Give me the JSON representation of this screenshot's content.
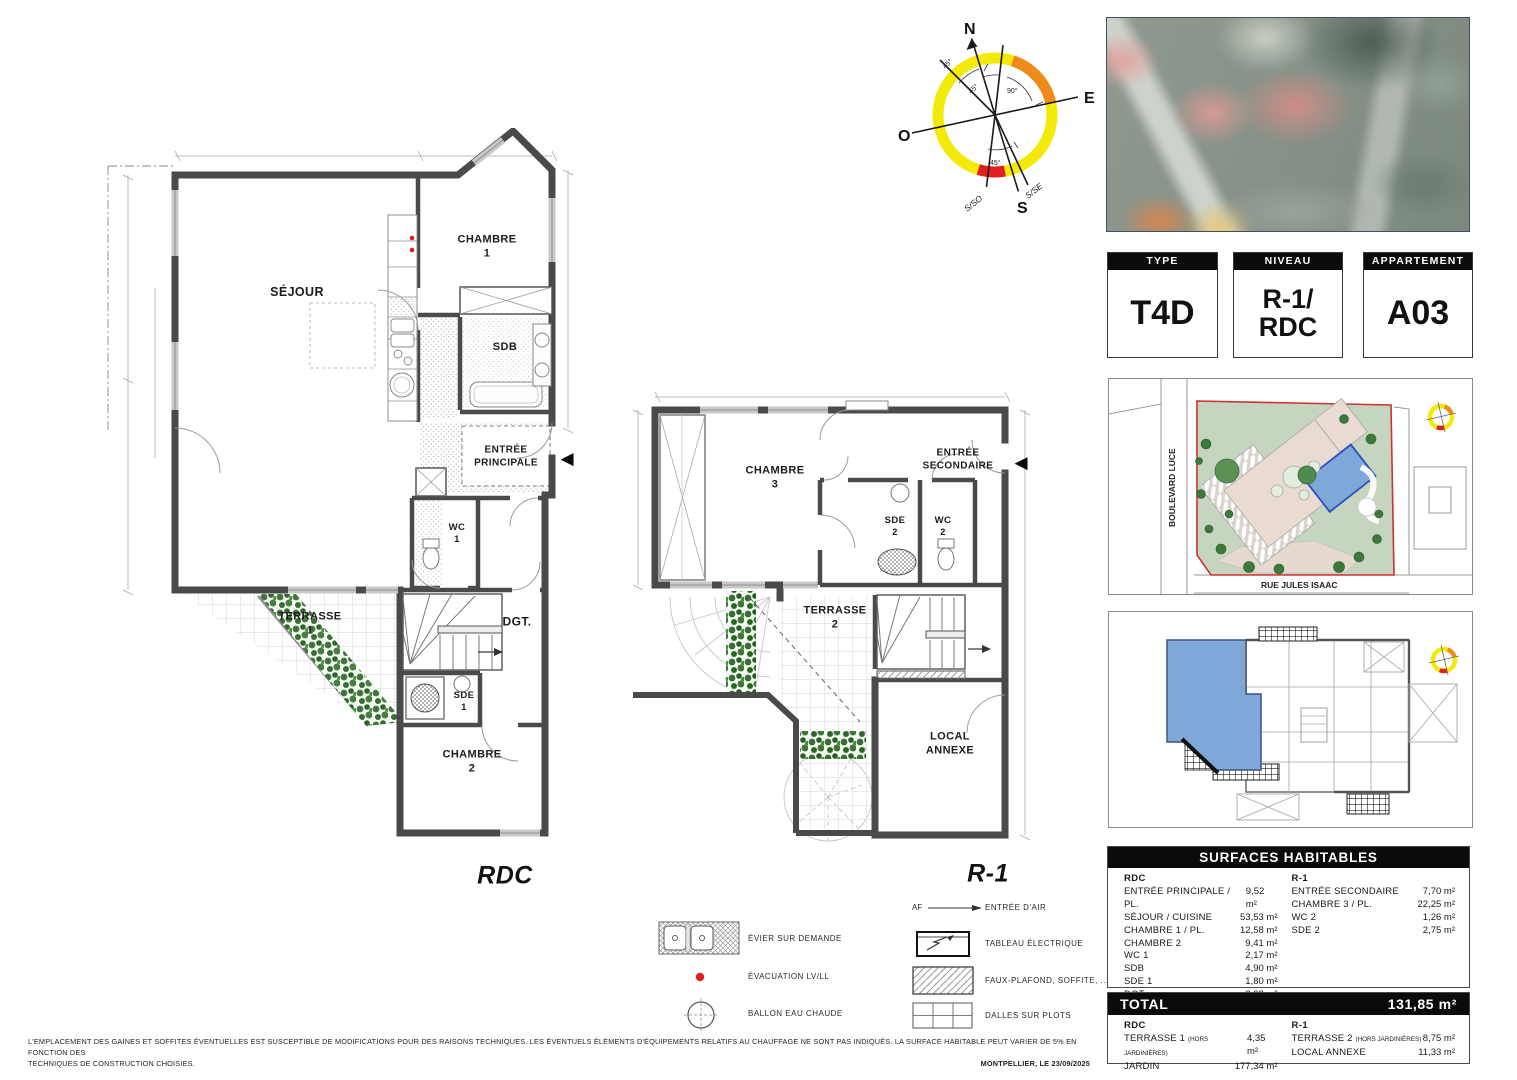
{
  "info_boxes": [
    {
      "header": "TYPE",
      "value": "T4D"
    },
    {
      "header": "NIVEAU",
      "value": "R-1/\nRDC"
    },
    {
      "header": "APPARTEMENT",
      "value": "A03"
    }
  ],
  "plans": {
    "rdc": {
      "caption": "RDC",
      "rooms": {
        "sejour": "SÉJOUR",
        "chambre1": "CHAMBRE\n1",
        "sdb": "SDB",
        "entree": "ENTRÉE\nPRINCIPALE",
        "wc1": "WC\n1",
        "terrasse1": "TERRASSE\n1",
        "dgt": "DGT.",
        "sde1": "SDE\n1",
        "chambre2": "CHAMBRE\n2"
      }
    },
    "r1": {
      "caption": "R-1",
      "rooms": {
        "chambre3": "CHAMBRE\n3",
        "entree": "ENTRÉE\nSECONDAIRE",
        "sde2": "SDE\n2",
        "wc2": "WC\n2",
        "terrasse2": "TERRASSE\n2",
        "local": "LOCAL\nANNEXE"
      }
    }
  },
  "compass": {
    "n": "N",
    "e": "E",
    "s": "S",
    "o": "O",
    "sso": "S/SO",
    "sse": "S/SE",
    "angles": [
      "45°",
      "45°",
      "90°",
      "45°"
    ]
  },
  "site_plan": {
    "street_left": "BOULEVARD LUCE",
    "street_bottom": "RUE JULES ISAAC"
  },
  "legend": {
    "left": [
      {
        "label": "ÉVIER SUR DEMANDE"
      },
      {
        "label": "ÉVACUATION LV/LL"
      },
      {
        "label": "BALLON EAU CHAUDE"
      }
    ],
    "right": [
      {
        "prefix": "AF",
        "label": "ENTRÉE D'AIR"
      },
      {
        "label": "TABLEAU ÉLECTRIQUE"
      },
      {
        "label": "FAUX-PLAFOND, SOFFITE, ..."
      },
      {
        "label": "DALLES SUR PLOTS"
      }
    ]
  },
  "surfaces": {
    "title": "SURFACES HABITABLES",
    "rdc": {
      "header": "RDC",
      "rows": [
        {
          "label": "ENTRÉE PRINCIPALE / PL.",
          "value": "9,52 m²"
        },
        {
          "label": "SÉJOUR / CUISINE",
          "value": "53,53 m²"
        },
        {
          "label": "CHAMBRE 1 / PL.",
          "value": "12,58 m²"
        },
        {
          "label": "CHAMBRE 2",
          "value": "9,41 m²"
        },
        {
          "label": "WC 1",
          "value": "2,17 m²"
        },
        {
          "label": "SDB",
          "value": "4,90 m²"
        },
        {
          "label": "SDE 1",
          "value": "1,80 m²"
        },
        {
          "label": "DGT.",
          "value": "3,98 m²"
        }
      ]
    },
    "r1": {
      "header": "R-1",
      "rows": [
        {
          "label": "ENTRÉE SECONDAIRE",
          "value": "7,70 m²"
        },
        {
          "label": "CHAMBRE 3 / PL.",
          "value": "22,25 m²"
        },
        {
          "label": "WC 2",
          "value": "1,26 m²"
        },
        {
          "label": "SDE 2",
          "value": "2,75 m²"
        }
      ]
    }
  },
  "total": {
    "label": "TOTAL",
    "value": "131,85 m²",
    "rdc": {
      "header": "RDC",
      "rows": [
        {
          "label": "TERRASSE 1 ",
          "note": "(HORS JARDINIÈRES)",
          "value": "4,35 m²"
        },
        {
          "label": "JARDIN",
          "note": "",
          "value": "177,34 m²"
        }
      ]
    },
    "r1": {
      "header": "R-1",
      "rows": [
        {
          "label": "TERRASSE 2 ",
          "note": "(HORS JARDINIÈRES)",
          "value": "8,75 m²"
        },
        {
          "label": "LOCAL ANNEXE",
          "note": "",
          "value": "11,33 m²"
        }
      ]
    }
  },
  "footer": {
    "line1": "L'EMPLACEMENT DES GAINES ET SOFFITES ÉVENTUELLES EST SUSCEPTIBLE DE MODIFICATIONS POUR DES RAISONS TECHNIQUES. LES ÉVENTUELS ÉLÉMENTS D'ÉQUIPEMENTS RELATIFS AU CHAUFFAGE NE SONT PAS INDIQUÉS. LA SURFACE HABITABLE PEUT VARIER DE 5% EN FONCTION DES",
    "line2": "TECHNIQUES DE CONSTRUCTION CHOISIES.",
    "date": "MONTPELLIER, LE 23/09/2025"
  },
  "colors": {
    "highlight_blue": "#7fa8d9",
    "boundary_red": "#d03030",
    "compass_yellow": "#f4ea08",
    "compass_orange": "#ef8b1d",
    "compass_red": "#e02020",
    "plant_green": "#35702f",
    "site_green": "#c6d5bf",
    "site_pink": "#e9dad2",
    "wall_gray": "#4a4a4a"
  }
}
